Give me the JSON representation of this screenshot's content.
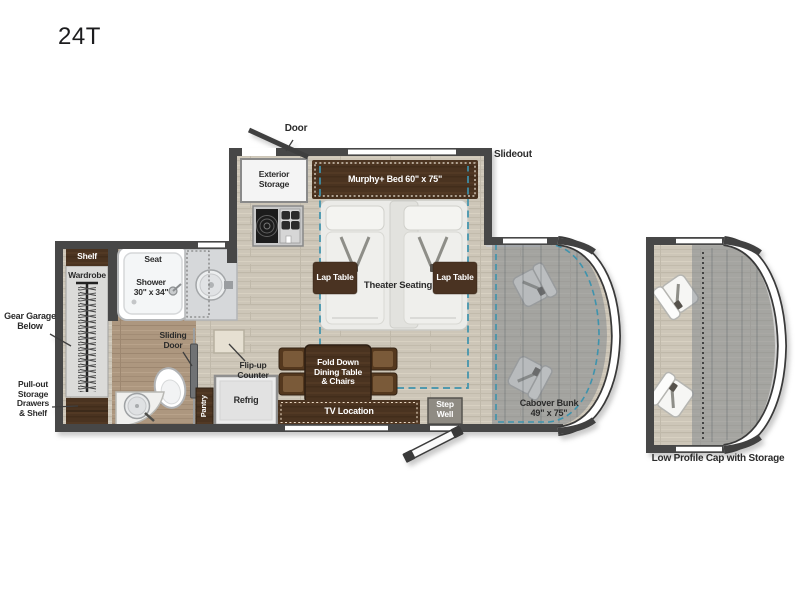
{
  "page": {
    "title": "24T"
  },
  "labels": {
    "door": "Door",
    "exterior_storage": "Exterior\nStorage",
    "murphy_bed": "Murphy+ Bed 60\" x 75\"",
    "slideout": "Slideout",
    "lap_table_left": "Lap Table",
    "lap_table_right": "Lap Table",
    "theater_seating": "Theater Seating",
    "shelf": "Shelf",
    "wardrobe": "Wardrobe",
    "seat": "Seat",
    "shower": "Shower\n30\" x 34\"",
    "gear_garage": "Gear Garage\nBelow",
    "pull_out_storage": "Pull-out\nStorage\nDrawers\n& Shelf",
    "sliding_door": "Sliding\nDoor",
    "flip_up_counter": "Flip-up\nCounter",
    "pantry": "Pantry",
    "refrig": "Refrig",
    "dining_table": "Fold Down\nDining Table\n& Chairs",
    "tv_location": "TV Location",
    "step_well": "Step\nWell",
    "cabover_bunk": "Cabover Bunk\n49\" x 75\"",
    "low_profile_cap": "Low Profile Cap with Storage"
  },
  "colors": {
    "wall": "#474747",
    "wood_floor": "#cdc6b8",
    "bath_floor": "#ad977f",
    "cabinet_wood": "#4a3320",
    "slide_dash": "#3e93ad",
    "bunk_overlay": "#7e848a",
    "label_dark": "#2b2b2b",
    "label_light": "#ffffff"
  }
}
